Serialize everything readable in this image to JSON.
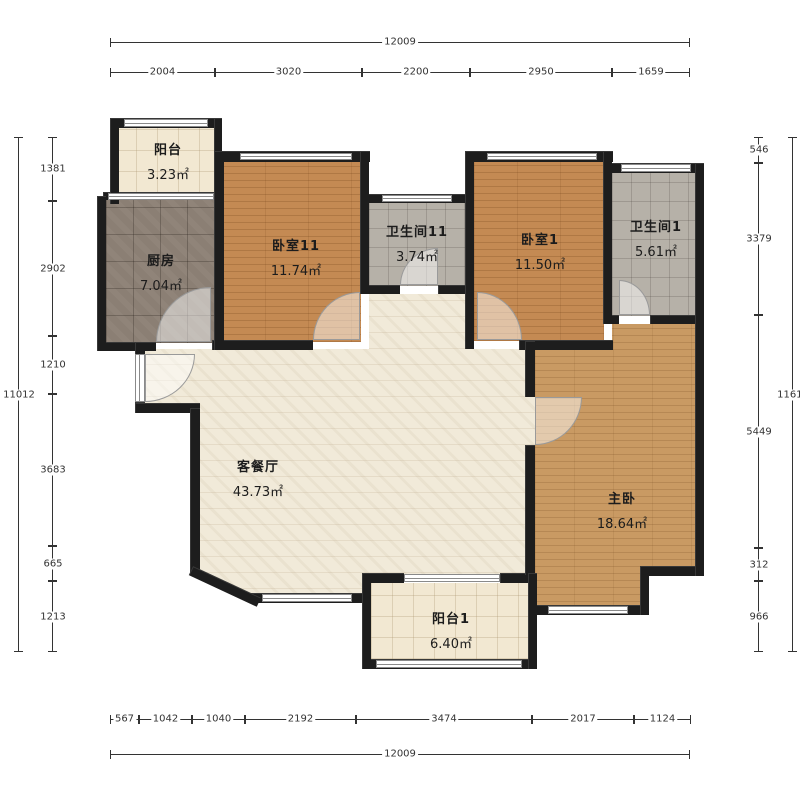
{
  "plan_title": "apartment-floor-plan",
  "rooms": [
    {
      "id": "balcony-tl",
      "name": "阳台",
      "area": "3.23㎡"
    },
    {
      "id": "kitchen",
      "name": "厨房",
      "area": "7.04㎡"
    },
    {
      "id": "bedroom-11",
      "name": "卧室11",
      "area": "11.74㎡"
    },
    {
      "id": "bathroom-11",
      "name": "卫生间11",
      "area": "3.74㎡"
    },
    {
      "id": "bedroom-1",
      "name": "卧室1",
      "area": "11.50㎡"
    },
    {
      "id": "bathroom-1",
      "name": "卫生间1",
      "area": "5.61㎡"
    },
    {
      "id": "living-dining",
      "name": "客餐厅",
      "area": "43.73㎡"
    },
    {
      "id": "master-bedroom",
      "name": "主卧",
      "area": "18.64㎡"
    },
    {
      "id": "balcony-1",
      "name": "阳台1",
      "area": "6.40㎡"
    }
  ],
  "dimensions": {
    "top": {
      "total": "12009",
      "segments": [
        "2004",
        "3020",
        "2200",
        "2950",
        "1659"
      ]
    },
    "bottom": {
      "total": "12009",
      "segments": [
        "567",
        "1042",
        "1040",
        "2192",
        "3474",
        "2017",
        "1124"
      ]
    },
    "left": {
      "total": "11012",
      "segments": [
        "1381",
        "2902",
        "1210",
        "3683",
        "665",
        "1213"
      ]
    },
    "right": {
      "total": "11612",
      "segments": [
        "546",
        "3379",
        "5449",
        "312",
        "966"
      ]
    }
  },
  "colors": {
    "wall": "#1d1d1d",
    "wood_floor": "#c48a53",
    "master_floor": "#c99a63",
    "gray_tile": "#b6b1a8",
    "kitchen_tile": "#8b7f74",
    "living_floor": "#f1ead9",
    "balcony_tile": "#f2e8d2"
  }
}
